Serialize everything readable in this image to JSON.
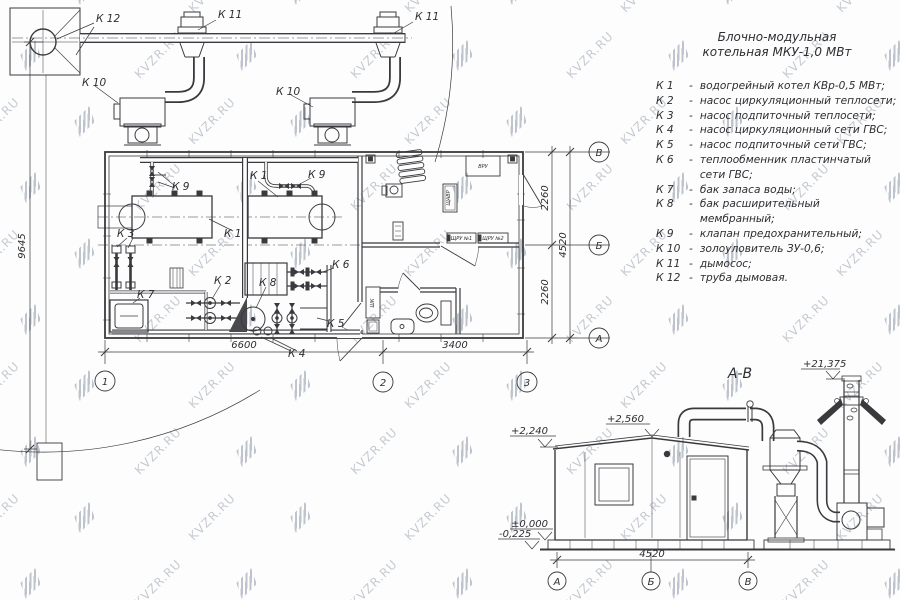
{
  "watermark": {
    "text": "KVZR.RU"
  },
  "title_block": {
    "line1": "Блочно-модульная",
    "line2": "котельная МКУ-1,0  МВт"
  },
  "legend": {
    "separator": "-",
    "items": [
      {
        "key": "К 1",
        "desc": "водогрейный котел КВр-0,5 МВт;"
      },
      {
        "key": "К 2",
        "desc": "насос циркуляционный теплосети;"
      },
      {
        "key": "К 3",
        "desc": "насос подпиточный теплосети;"
      },
      {
        "key": "К 4",
        "desc": "насос циркуляционный сети ГВС;"
      },
      {
        "key": "К 5",
        "desc": "насос подпиточный сети ГВС;"
      },
      {
        "key": "К 6",
        "desc": "теплообменник пластинчатый сети ГВС;"
      },
      {
        "key": "К 7",
        "desc": "бак запаса воды;"
      },
      {
        "key": "К 8",
        "desc": "бак расширительный мембранный;"
      },
      {
        "key": "К 9",
        "desc": "клапан предохранительный;"
      },
      {
        "key": "К 10",
        "desc": "золоуловитель ЗУ-0,6;"
      },
      {
        "key": "К 11",
        "desc": "дымосос;"
      },
      {
        "key": "К 12",
        "desc": "труба дымовая."
      }
    ]
  },
  "plan": {
    "equipment_labels": {
      "k12": "К 12",
      "k11_left": "К 11",
      "k11_right": "К 11",
      "k10_left": "К 10",
      "k10_right": "К 10",
      "k9_left": "К 9",
      "k9_right": "К 9",
      "k1_top": "К 1",
      "k1_bottom": "К 1",
      "k3": "К 3",
      "k7": "К 7",
      "k2": "К 2",
      "k8": "К 8",
      "k6": "К 6",
      "k5": "К 5",
      "k4": "К 4"
    },
    "room_labels": {
      "vru": "ВРУ",
      "schru1": "ЩРУ №1",
      "schru2": "ЩРУ №2",
      "shk": "ШК",
      "panel": "ЩАВР"
    },
    "dimensions": {
      "d6600": "6600",
      "d3400": "3400",
      "d2260a": "2260",
      "d2260b": "2260",
      "d4520": "4520",
      "d9645": "9645"
    },
    "axes": {
      "a1": "1",
      "a2": "2",
      "a3": "3",
      "row_v": "В",
      "row_b": "Б",
      "row_a": "А"
    }
  },
  "elevation": {
    "title": "А-В",
    "marks": {
      "chimney_top": "+21,375",
      "ridge": "+2,560",
      "eave": "+2,240",
      "zero": "±0,000",
      "below_zero": "-0,225"
    },
    "dimensions": {
      "width": "4520"
    },
    "axes": {
      "a": "А",
      "b": "Б",
      "v": "В"
    }
  }
}
